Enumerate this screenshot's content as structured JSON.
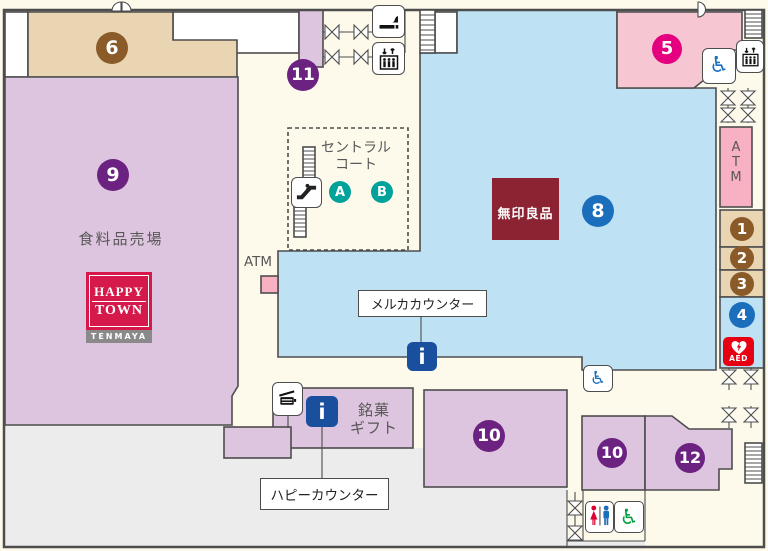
{
  "floor_map": {
    "store_label": "食料品売場",
    "central_court": {
      "line1": "セントラル",
      "line2": "コート",
      "point_a": "A",
      "point_b": "B"
    },
    "muji_label": "無印良品",
    "gift_label": {
      "line1": "銘菓",
      "line2": "ギフト"
    },
    "counters": {
      "meruka": "メルカカウンター",
      "happy": "ハピーカウンター"
    },
    "atm_side_label": "ATM",
    "atm_vertical": {
      "l1": "A",
      "l2": "T",
      "l3": "M"
    },
    "aed_label": "AED",
    "logo": {
      "line1": "HAPPY",
      "line2": "TOWN",
      "sub": "TENMAYA"
    },
    "markers": {
      "m1": "1",
      "m2": "2",
      "m3": "3",
      "m4": "4",
      "m5": "5",
      "m6": "6",
      "m8": "8",
      "m9": "9",
      "m10a": "10",
      "m10b": "10",
      "m11": "11",
      "m12": "12",
      "a": "A",
      "b": "B"
    }
  },
  "colors": {
    "bg": "#fdfaec",
    "border": "#4d4d4d",
    "purple": "#ddc4df",
    "tan": "#ead5b3",
    "pink5": "#f6c6d3",
    "blue8": "#bee2f4",
    "atmpink": "#f8b0c3",
    "gray": "#ececec",
    "muji": "#8c2333",
    "logored": "#d6194b",
    "logogray": "#8a8a8a",
    "info": "#1a4f9d",
    "aedred": "#e60012",
    "toiletred": "#dc0032",
    "toiletblue": "#1b6ebc",
    "toiletgreen": "#00a040",
    "textgray": "#595757",
    "mpurple": "#6c2280",
    "mbrown": "#8a5a28",
    "mblue": "#1b6ebc",
    "mpink": "#e4007f",
    "mteal": "#00a29a"
  }
}
